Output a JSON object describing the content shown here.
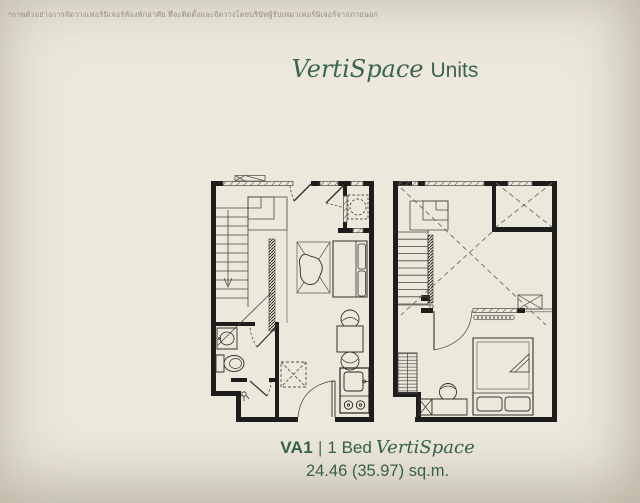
{
  "page": {
    "background": "#ece8db",
    "accent_green": "#3d6452",
    "wall_ink": "#1d1d1b",
    "disclaimer_color": "#9b9486"
  },
  "disclaimer": {
    "text": "*ภาพตัวอย่างการจัดวางเฟอร์นิเจอร์ห้องพักอาศัย ที่จะติดตั้งและจัดวางโดยบริษัทผู้รับเหมาเฟอร์นิเจอร์จากภายนอก"
  },
  "title": {
    "brand": "VertiSpace",
    "suffix": "Units"
  },
  "caption": {
    "code": "VA1",
    "separator": "|",
    "bed_type": "1 Bed",
    "brand": "VertiSpace",
    "area": "24.46 (35.97) sq.m."
  },
  "plans": {
    "lower": {
      "id": "lower-floor-plan",
      "features": [
        "staircase",
        "down-arrow",
        "ac-unit",
        "balcony",
        "washing-machine",
        "balcony-door",
        "rug",
        "coffee-table",
        "sofa",
        "dining-table",
        "dining-chairs",
        "refrigerator-space",
        "kitchen-counter",
        "sink",
        "stove-burners",
        "bathroom",
        "basin",
        "toilet",
        "shower",
        "shower-head",
        "bathroom-door",
        "shower-door",
        "entrance-door",
        "windows"
      ]
    },
    "upper": {
      "id": "upper-floor-plan",
      "features": [
        "staircase",
        "void-cross",
        "void-box",
        "railing",
        "curtain-coil",
        "ac-ledge-box",
        "bedroom-door",
        "glazed-partition",
        "wardrobe",
        "desk",
        "desk-chair",
        "shaft-box",
        "double-bed",
        "pillows",
        "blanket-fold",
        "windows"
      ]
    }
  }
}
